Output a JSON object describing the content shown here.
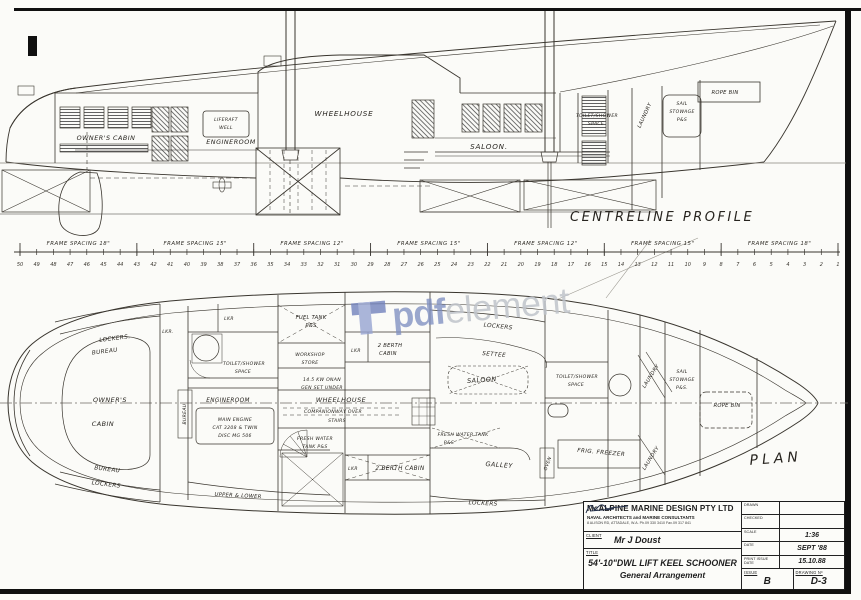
{
  "watermark": {
    "brand_bold": "pdf",
    "brand_light": "element",
    "logo_color_dark": "#7282bd",
    "logo_color_light": "#97a4d2",
    "text_bold_color": "#8090c2",
    "text_light_color": "#c0c4cb"
  },
  "profile": {
    "title": "CENTRELINE PROFILE",
    "labels": {
      "owners_cabin": "OWNER'S CABIN",
      "engineroom": "ENGINEROOM",
      "liferaft1": "LIFERAFT",
      "liferaft2": "WELL",
      "wheelhouse": "WHEELHOUSE",
      "saloon": "SALOON.",
      "toilet1": "TOILET/SHOWER",
      "toilet2": "SPACE",
      "laundry": "LAUNDRY",
      "sail1": "SAIL",
      "sail2": "STOWAGE",
      "sail3": "P&S",
      "rope_bin": "ROPE BIN"
    }
  },
  "ruler": {
    "segments": [
      "FRAME SPACING 18\"",
      "FRAME SPACING 15\"",
      "FRAME SPACING 12\"",
      "FRAME SPACING 15\"",
      "FRAME SPACING 12\"",
      "FRAME SPACING 15\"",
      "FRAME SPACING 18\""
    ],
    "frame_numbers": [
      "50",
      "49",
      "48",
      "47",
      "46",
      "45",
      "44",
      "43",
      "42",
      "41",
      "40",
      "39",
      "38",
      "37",
      "36",
      "35",
      "34",
      "33",
      "32",
      "31",
      "30",
      "29",
      "28",
      "27",
      "26",
      "25",
      "24",
      "23",
      "22",
      "21",
      "20",
      "19",
      "18",
      "17",
      "16",
      "15",
      "14",
      "13",
      "12",
      "11",
      "10",
      "9",
      "8",
      "7",
      "6",
      "5",
      "4",
      "3",
      "2",
      "1"
    ]
  },
  "plan": {
    "title": "PLAN",
    "labels": {
      "lockers_aft_top": "LOCKERS.",
      "bureau_aft_top": "BUREAU",
      "lkr_top_a": "LKR.",
      "lkr_top_b": "LKR",
      "fuel1": "FUEL TANK",
      "fuel2": "P&S",
      "toilet_aft1": "TOILET/SHOWER",
      "toilet_aft2": "SPACE",
      "engineroom": "ENGINEROOM",
      "workshop1": "WORKSHOP",
      "workshop2": "STORE",
      "lkr_mid": "LKR",
      "berth_fwd1": "2 BERTH",
      "berth_fwd2": "CABIN",
      "genset1": "14.5 KW ONAN",
      "genset2": "GEN SET UNDER",
      "wheelhouse": "WHEELHOUSE",
      "companionway": "COMPANIONWAY OVER",
      "stairs": "STAIRS",
      "freshwater_port1": "FRESH WATER",
      "freshwater_port2": "TANK P&S",
      "main_engine1": "MAIN ENGINE",
      "main_engine2": "CAT 3208 & TWIN",
      "main_engine3": "DISC MG 506",
      "bureau_vert": "BUREAU",
      "owners1": "OWNER'S",
      "owners2": "CABIN",
      "bureau_aft_bottom": "BUREAU",
      "lockers_aft_bottom": "LOCKERS",
      "upper_lower": "UPPER & LOWER",
      "lkr_bottom": "LKR",
      "berth_aft": "2 BERTH CABIN",
      "lockers_fwd_top": "LOCKERS",
      "settee": "SETTEE",
      "saloon": "SALOON",
      "toilet_fwd1": "TOILET/SHOWER",
      "toilet_fwd2": "SPACE",
      "laundry_fwd": "LAUNDRY",
      "sail1": "SAIL",
      "sail2": "STOWAGE",
      "sail3": "P&S.",
      "rope_bin": "ROPE BIN",
      "freshwater_stbd1": "FRESH WATER TANK",
      "freshwater_stbd2": "P&S",
      "galley": "GALLEY",
      "oven": "OVEN",
      "frig_freezer": "FRIG. FREEZER",
      "laundry_aft": "LAUNDRY",
      "lockers_galley": "LOCKERS"
    }
  },
  "title_block": {
    "company": "McALPINE MARINE DESIGN PTY LTD",
    "subtitle": "NAVAL ARCHITECTS and MARINE CONSULTANTS",
    "address": "8 ALISON RD, ATTADALE, W.A.   Ph.09 330 3410   Fax.09 317 841",
    "client_label": "CLIENT",
    "client": "Mr J Doust",
    "title_label": "TITLE",
    "title_line1": "54'-10\"DWL LIFT KEEL SCHOONER",
    "title_line2": "General Arrangement",
    "drawn_label": "DRAWN",
    "checked_label": "CHECKED",
    "scale_label": "SCALE",
    "scale_value": "1:36",
    "date_label": "DATE",
    "date_value": "SEPT '88",
    "print_label": "PRINT ISSUE DATE",
    "print_value": "15.10.88",
    "issue_label": "ISSUE",
    "issue_value": "B",
    "drawing_label": "DRAWING Nº",
    "drawing_value": "D-3"
  }
}
